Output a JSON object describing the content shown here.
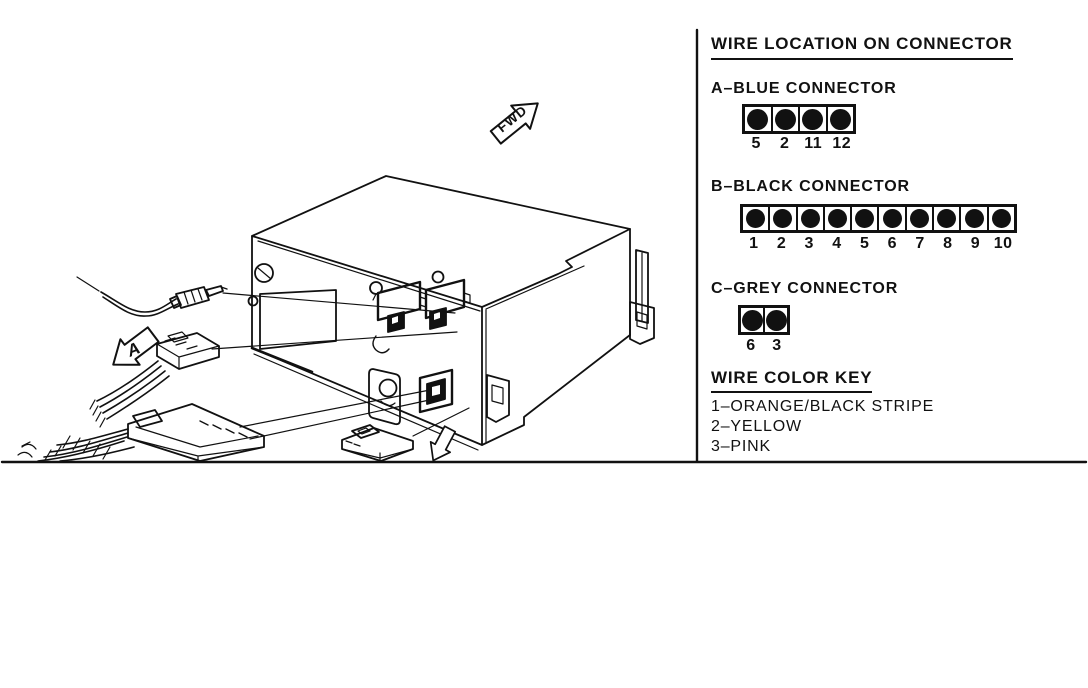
{
  "panel": {
    "title": "WIRE LOCATION ON CONNECTOR",
    "connectors": [
      {
        "label": "A–BLUE CONNECTOR",
        "pins": [
          "5",
          "2",
          "11",
          "12"
        ]
      },
      {
        "label": "B–BLACK CONNECTOR",
        "pins": [
          "1",
          "2",
          "3",
          "4",
          "5",
          "6",
          "7",
          "8",
          "9",
          "10"
        ]
      },
      {
        "label": "C–GREY CONNECTOR",
        "pins": [
          "6",
          "3"
        ]
      }
    ],
    "color_key": {
      "title": "WIRE COLOR KEY",
      "items": [
        "1–ORANGE/BLACK STRIPE",
        "2–YELLOW",
        "3–PINK"
      ]
    }
  },
  "illustration": {
    "fwd_label": "FWD",
    "detail_label": "A"
  },
  "colors": {
    "ink": "#111111",
    "paper": "#ffffff"
  }
}
